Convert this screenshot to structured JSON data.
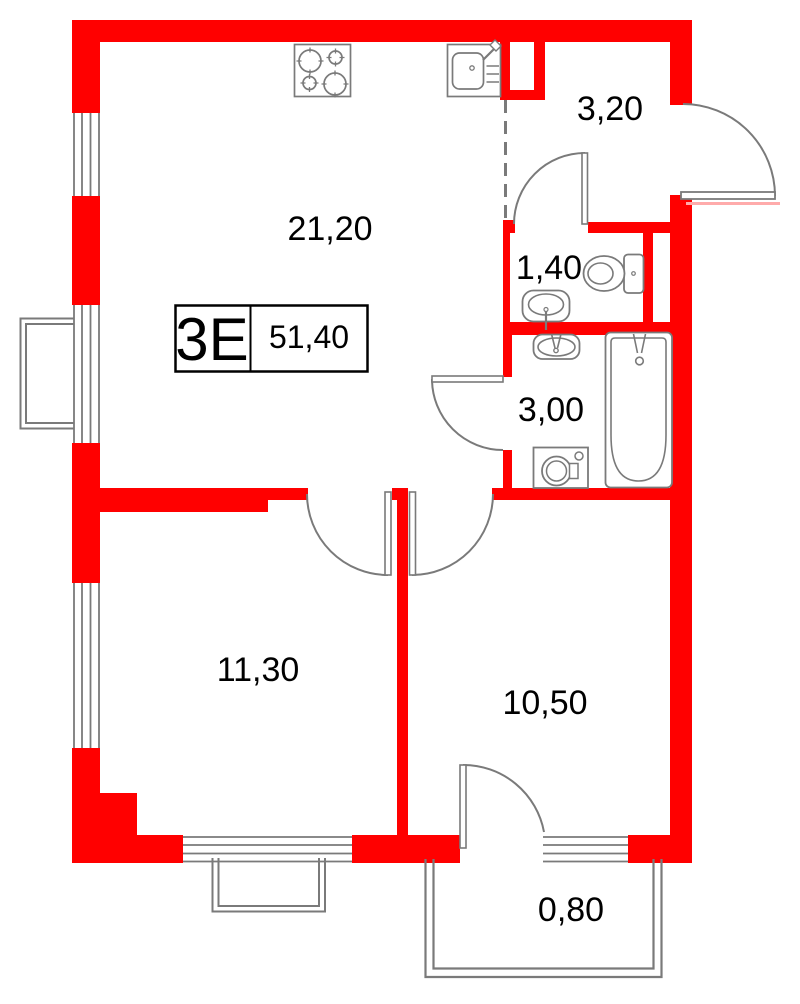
{
  "unit": {
    "code": "3Е",
    "total_area": "51,40"
  },
  "rooms": {
    "living_kitchen": "21,20",
    "hallway": "3,20",
    "wc": "1,40",
    "bathroom": "3,00",
    "bedroom": "11,30",
    "room": "10,50",
    "balcony": "0,80"
  },
  "colors": {
    "wall": "#ff0000",
    "lines": "#7a7a7a",
    "text": "#000000",
    "entry_sill": "#ffabab"
  },
  "fixtures": [
    "stove",
    "kitchen-sink",
    "toilet",
    "wc-sink",
    "bathroom-sink",
    "bathtub",
    "washing-machine"
  ]
}
